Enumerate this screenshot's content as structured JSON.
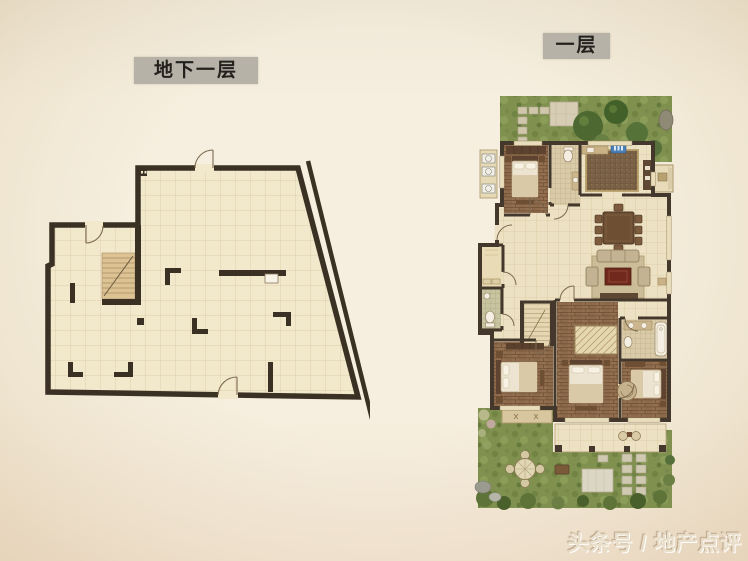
{
  "labels": {
    "basement": "地下一层",
    "first_floor": "一层"
  },
  "watermark": {
    "text": "头条号 / 地产点评"
  },
  "colors": {
    "page_background": "#f3ecdc",
    "label_box_bg": "#b6b2a8",
    "label_text": "#24211d",
    "wall": "#3a3124",
    "tile_floor": "#f2e8cc",
    "tile_grid": "#d8c7a2",
    "wood_floor": "#8d6a4b",
    "grass_green": "#80914f",
    "tree_green": "#4d6830",
    "rug_red": "#71291d",
    "accent_blue": "#4a7fb5",
    "watermark_emboss": "#e9dec9"
  }
}
